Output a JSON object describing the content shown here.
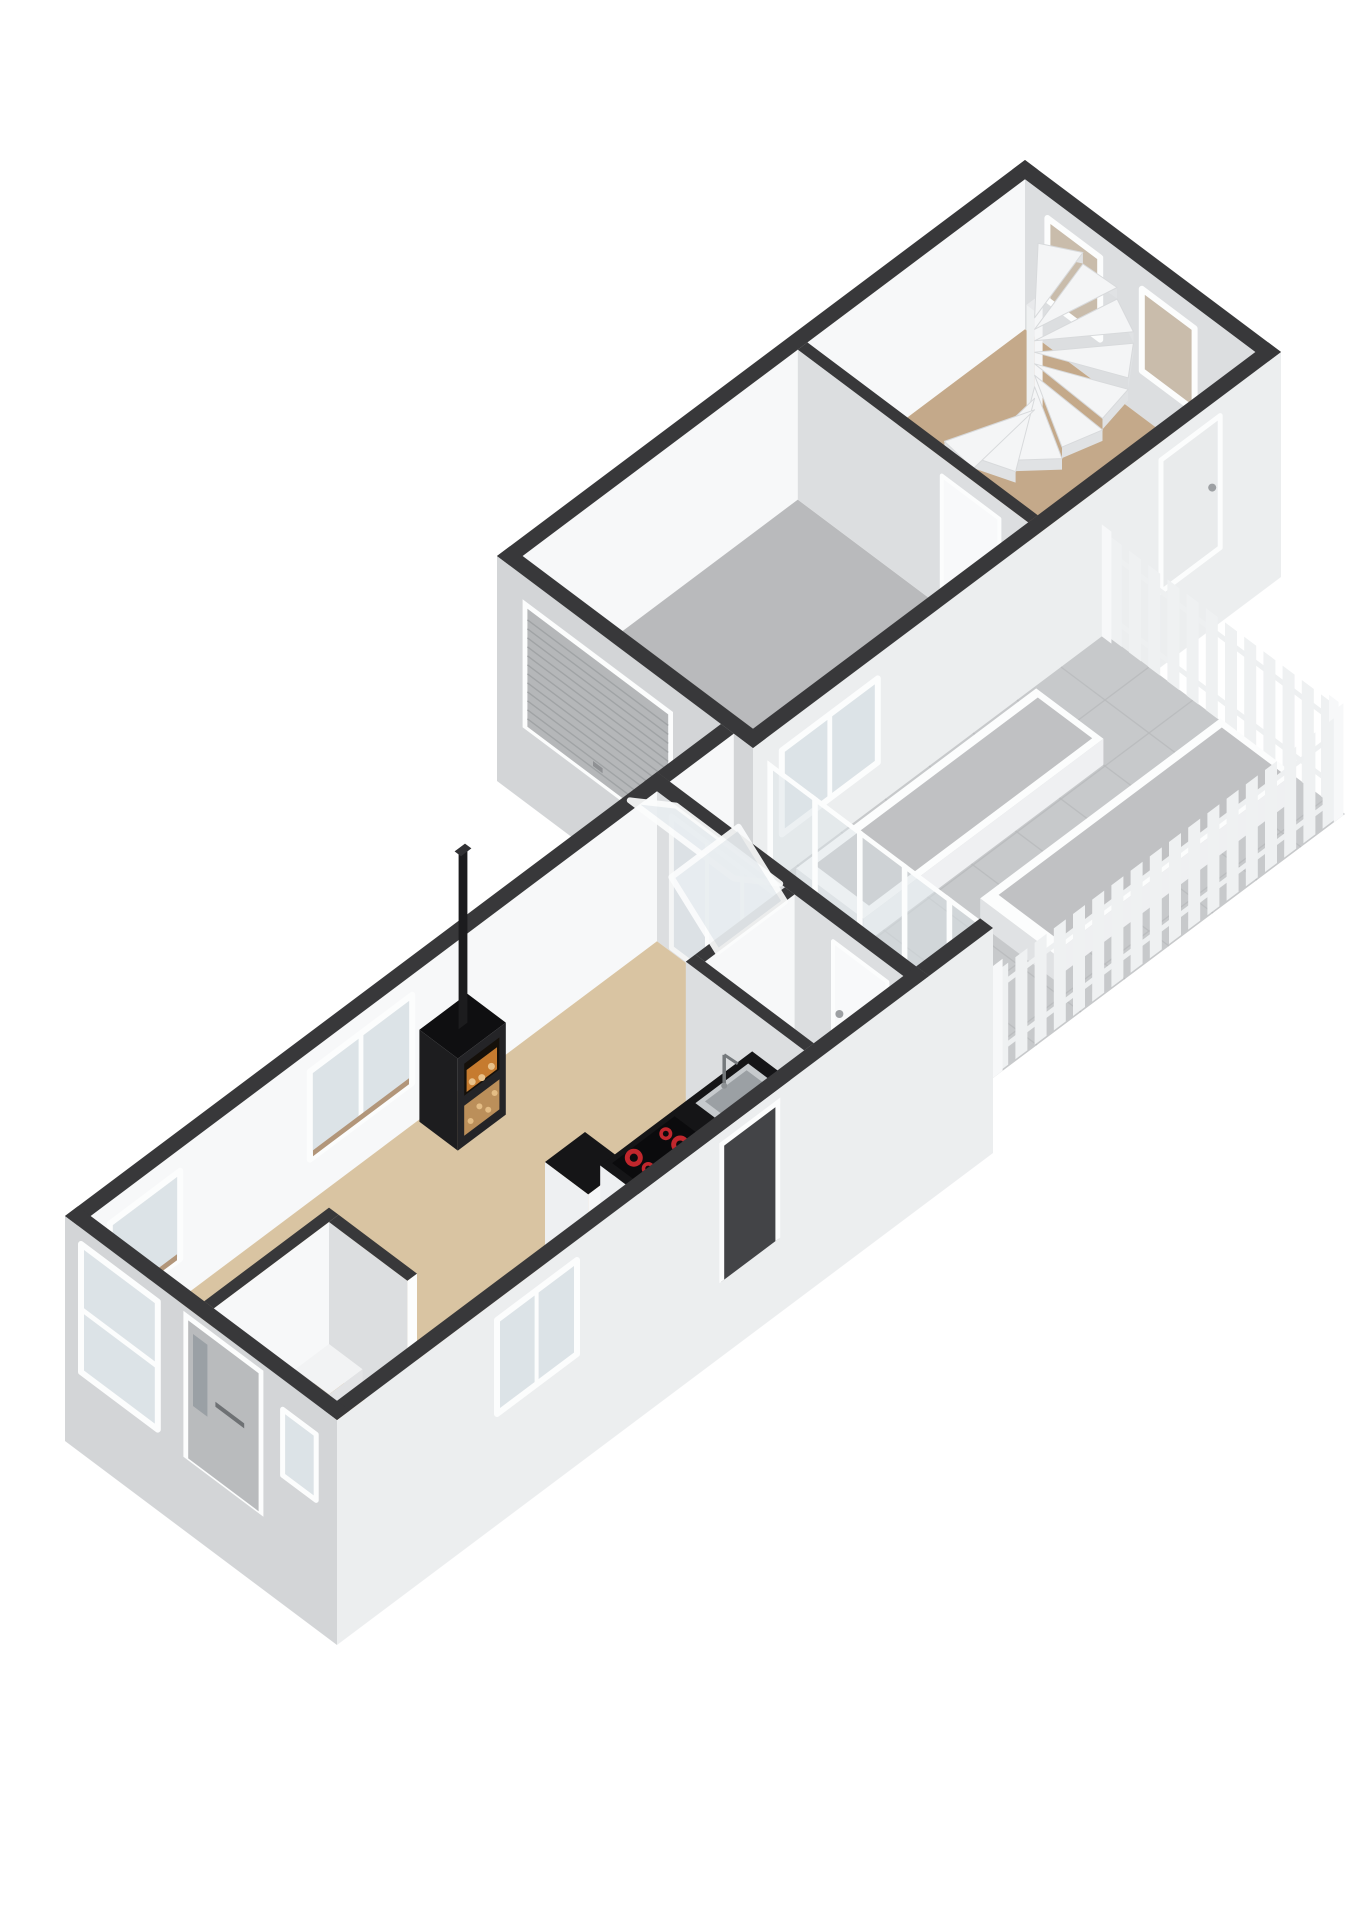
{
  "page": {
    "background": "#ffffff",
    "title": "3D axonometric cutaway floor plan render: main house with living room, kitchen, bathroom and entry room; connector corridor; tiled patio with raised planters and slatted fences; garage building with sectional door and stair hall with spiral staircase"
  },
  "colors": {
    "wall_cap": "#38383a",
    "wall_inner_light": "#f7f8f9",
    "wall_inner_shade": "#dcdee0",
    "wall_ext_sw": "#d3d5d7",
    "wall_ext_se": "#eceeef",
    "frame_white": "#fcfdfd",
    "glass": "#dce3e7",
    "glass_frost": "#e9eef1",
    "glass_brown": "#c9bcab",
    "sill_brown": "#b2967a",
    "floor_living": "#d9c4a2",
    "floor_entry": "#d09a51",
    "floor_kitchen": "#ccd7e1",
    "floor_bath": "#c6d1dc",
    "floor_corridor": "#d2d3d5",
    "floor_garage": "#b9babc",
    "floor_stair_hall": "#c4a98a",
    "floor_patio": "#c7c9cb",
    "tile_line": "#b9bbbd",
    "fence_slat": "#eff1f2",
    "planter_gravel": "#c0c1c3",
    "counter_top": "#151517",
    "cabinet_white": "#eef0f2",
    "burner_red": "#c1272d",
    "sink_steel": "#c6cacd",
    "stove_black": "#1d1d1f",
    "stove_top": "#0f0f11",
    "fire_orange": "#d08232",
    "wood_tan": "#bb8f5a",
    "door_gray": "#b9bbbd",
    "garage_door": "#b5b7b9",
    "garage_door_rib": "#a0a3a5",
    "step_white": "#f2f3f4"
  },
  "scene": {
    "view": "axonometric cutaway render, no roof, wall tops cut dark charcoal, transparent background",
    "burner_count": 4,
    "buildings": [
      {
        "name": "main-house",
        "rooms": [
          {
            "name": "living-room",
            "floor_color_ref": "floor_living",
            "fixtures": [
              "wood-stove-with-chimney",
              "window-nw-small",
              "window-nw-large"
            ]
          },
          {
            "name": "kitchen",
            "floor_color_ref": "floor_kitchen",
            "fixtures": [
              "tall-cabinet",
              "counter-with-induction-hob",
              "sink-with-faucet"
            ]
          },
          {
            "name": "bathroom",
            "floor_color_ref": "floor_bath",
            "fixtures": [
              "door-to-corridor",
              "tilted-vent-window"
            ]
          },
          {
            "name": "entry-room",
            "floor_color_ref": "floor_entry",
            "fixtures": [
              "step",
              "doorway"
            ]
          },
          {
            "name": "dining-nook",
            "floor_color_ref": "floor_living",
            "fixtures": [
              "tilted-vent-window",
              "glazed-sliding-opening"
            ]
          }
        ],
        "facade_fixtures": [
          "front-door",
          "window-sw-tall",
          "window-sw-small",
          "window-se",
          "se-doorway"
        ]
      },
      {
        "name": "connector-corridor",
        "floor_color_ref": "floor_corridor"
      },
      {
        "name": "garage-building",
        "rooms": [
          {
            "name": "garage",
            "floor_color_ref": "floor_garage",
            "fixtures": [
              "sectional-garage-door",
              "window-to-patio"
            ]
          },
          {
            "name": "stair-hall",
            "floor_color_ref": "floor_stair_hall",
            "fixtures": [
              "spiral-staircase",
              "window-1",
              "window-2",
              "exterior-door",
              "interior-door"
            ]
          }
        ]
      },
      {
        "name": "patio",
        "floor_color_ref": "floor_patio",
        "fixtures": [
          "raised-planter-1",
          "raised-planter-2",
          "slatted-fence-southeast",
          "slatted-fence-northeast",
          "sliding-glass-wall"
        ]
      }
    ]
  }
}
